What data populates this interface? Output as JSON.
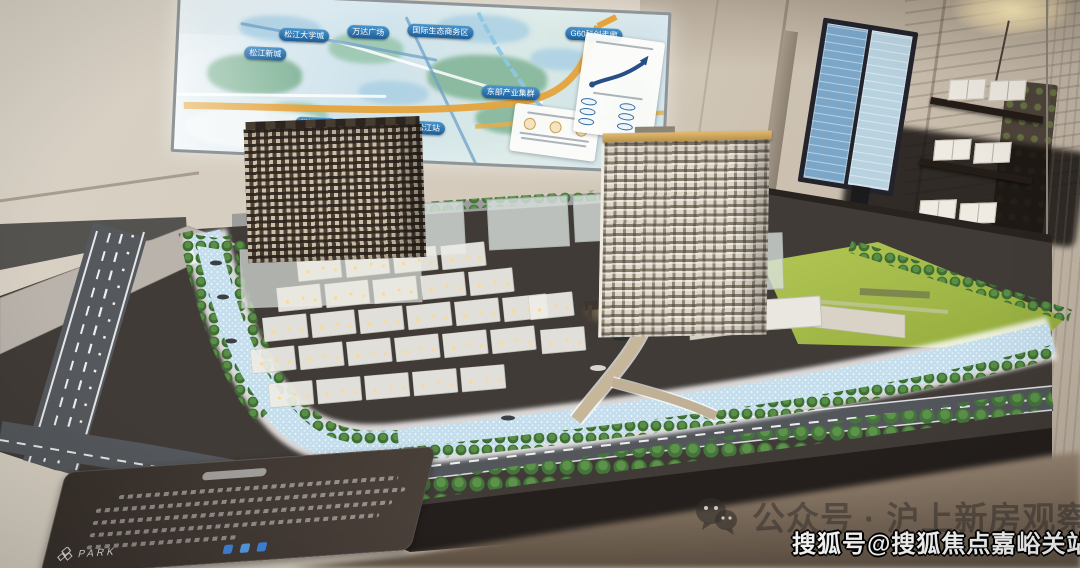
{
  "scene": {
    "description": "Real-estate sales center: architectural scale model on a table with an illuminated regional map screen on the wall"
  },
  "screen": {
    "labels": [
      {
        "id": "songjiang-xincheng",
        "text": "松江新城"
      },
      {
        "id": "songjiang-daxuecheng",
        "text": "松江大学城"
      },
      {
        "id": "wanda-plaza",
        "text": "万达广场"
      },
      {
        "id": "intl-eco-business-district",
        "text": "国际生态商务区"
      },
      {
        "id": "eastern-industry-cluster",
        "text": "东部产业集群"
      },
      {
        "id": "g60-corridor",
        "text": "G60科创走廊"
      },
      {
        "id": "songjiang-laocheng",
        "text": "松江老城"
      },
      {
        "id": "shanghai-songjiang-station",
        "text": "上海松江站"
      }
    ]
  },
  "model": {
    "plaque": {
      "logo_text": "PARK"
    }
  },
  "watermarks": {
    "wechat": {
      "icon": "wechat-icon",
      "text": "公众号 · 沪上新房观察"
    },
    "sohu": {
      "text": "搜狐号@搜狐焦点嘉峪关站"
    }
  },
  "colors": {
    "map_pill_blue": "#2a6db0",
    "map_highway_orange": "#e2a23e",
    "river_blue": "#cfe4ef",
    "lawn_green": "#a9bf4a",
    "tree_green": "#4c7c3c",
    "watermark_gray": "#3c3832",
    "watermark_white": "#ffffff"
  }
}
